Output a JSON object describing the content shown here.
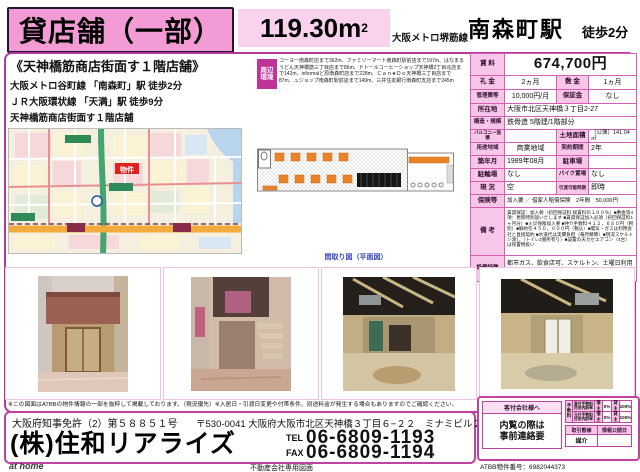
{
  "colors": {
    "frame": "#B5389E",
    "header_pink": "#F39BD5",
    "light_pink": "#FAD2EE",
    "cell_pink": "#F8C6E8",
    "cell_border": "#D65FB4",
    "env_label_bg": "#C03399",
    "marker_red": "#E02020",
    "caption_blue": "#3344BB"
  },
  "header": {
    "property_type": "貸店舗（一部）",
    "area_value": "119.30",
    "area_unit": "m",
    "area_sup": "2",
    "line": "大阪メトロ堺筋線",
    "station": "南森町駅",
    "walk": "徒歩2分"
  },
  "catch": {
    "title": "《天神橋筋商店街面す１階店舗》",
    "access1": "大阪メトロ谷町線 「南森町」駅 徒歩2分",
    "access2": "ＪＲ大阪環状線 「天満」駅 徒歩9分",
    "feature1": "天神橋筋商店街面す１階店舗",
    "feature2": "飲食業種相談　現況スケルトン（トイレ有り）"
  },
  "surroundings": {
    "label": "周辺環境",
    "text": "コーヨー南森町店まで362m、ファミリーマート南森町駅前店まで197m、はなまるうどん天神橋筋三丁目店まで86m、ドトールコーヒーショップ天神橋2丁目北店まで142m、informalど原南森町店まで228m、Ｃａｎ★Ｄｏ天神橋三丁目店まで87m、ュジョップ南森町駅前店まで149m、三井住友銀行南森町支店まで245m"
  },
  "map": {
    "marker": "物件"
  },
  "floorplan": {
    "caption": "間取り図（平面図）"
  },
  "spec": {
    "rent_label": "賃 料",
    "rent": "674,700円",
    "reikin_label": "礼 金",
    "reikin": "2ヵ月",
    "shikikin_label": "敷 金",
    "shikikin": "1ヵ月",
    "kanrihi_label": "管理費等",
    "kanrihi": "10,000円/月",
    "hoshokin_label": "保証金",
    "hoshokin": "なし",
    "address_label": "所在地",
    "address": "大阪市北区天神橋３丁目2-27",
    "structure_label": "構造・規模",
    "structure": "鉄骨造 5階建/1階部分",
    "balcony_label": "バルコニー面積",
    "balcony": "",
    "land_label": "土地面積",
    "land": "（公簿）141.04㎡",
    "zoning_label": "用途地域",
    "zoning": "商業地域",
    "term_label": "契約期間",
    "term": "2年",
    "built_label": "築年月",
    "built": "1989年08月",
    "parking_label": "駐車場",
    "parking": "",
    "bicycle_label": "駐輪場",
    "bicycle": "なし",
    "bike_label": "バイク置場",
    "bike": "なし",
    "status_label": "現 況",
    "status": "空",
    "handover_label": "引渡可能時期",
    "handover": "即時",
    "insurance_label": "保険等",
    "insurance": "加入要 ／ 借家人賠償保険　2年間　50,000円",
    "notes_label": "備 考",
    "notes": "賃貸保証：加入要（初回保証料 総賃料の１００％）■敷金等4項：更新時別途いたします ■賃貸保証加入必須（初回保証料1ヶ月分）■火災保険加入要 ■仲介手数料４１２，６８０円（税別）■解約引４５０，０００円（税込）■電気・ガスは利用会社と直接契約 ■水道代は実費負担（毎月精算）■現況スケルトン渡し（トイレ2箇所有り）■設置の天カセエアコン（4台）は残置物扱い",
    "features_label": "設備特徴",
    "features": "都市ガス、飲食店可、スケルトン、土曜日利用可、土日・祝日利用可、ＩＴ重説対応物件"
  },
  "disclaimer": "※この図面はATBBの物件情報の一部を抜粋して掲載しております。（現況優先）※入居日・引渡日変更や付帯条件、別途料金が発生する場合もありますのでご確認ください。",
  "publisher": {
    "license": "大阪府知事免許（2）第５８８５１号",
    "name": "(株)住和リアライズ",
    "postal_address": "〒530-0041 大阪府大阪市北区天神橋３丁目６−２２　ミナミビル２階",
    "tel_label": "TEL",
    "tel": "06-6809-1193",
    "fax_label": "FAX",
    "fax": "06-6809-1194"
  },
  "agent": {
    "header": "客付会社様へ",
    "note1": "内覧の際は",
    "note2": "事前連絡要",
    "fee_label": "手数料",
    "fee1_name": "客付手数料 目安内訳率",
    "fee1_t1": "借主",
    "fee1_v1": "0%",
    "fee1_t2": "貸主",
    "fee1_v2": "100%",
    "fee2_name": "元付手数料 目安内訳率",
    "fee2_t1": "借主",
    "fee2_v1": "0%",
    "fee2_t2": "貸主",
    "fee2_v2": "100%",
    "deal_type_label": "取引態様",
    "deal_type": "媒介",
    "publish_label": "情報公開日",
    "publish": ""
  },
  "footer": {
    "athome_logo": "at home",
    "internal_note": "不動産会社専用図面",
    "atbb_number": "ATBB物件番号：6982044373"
  }
}
